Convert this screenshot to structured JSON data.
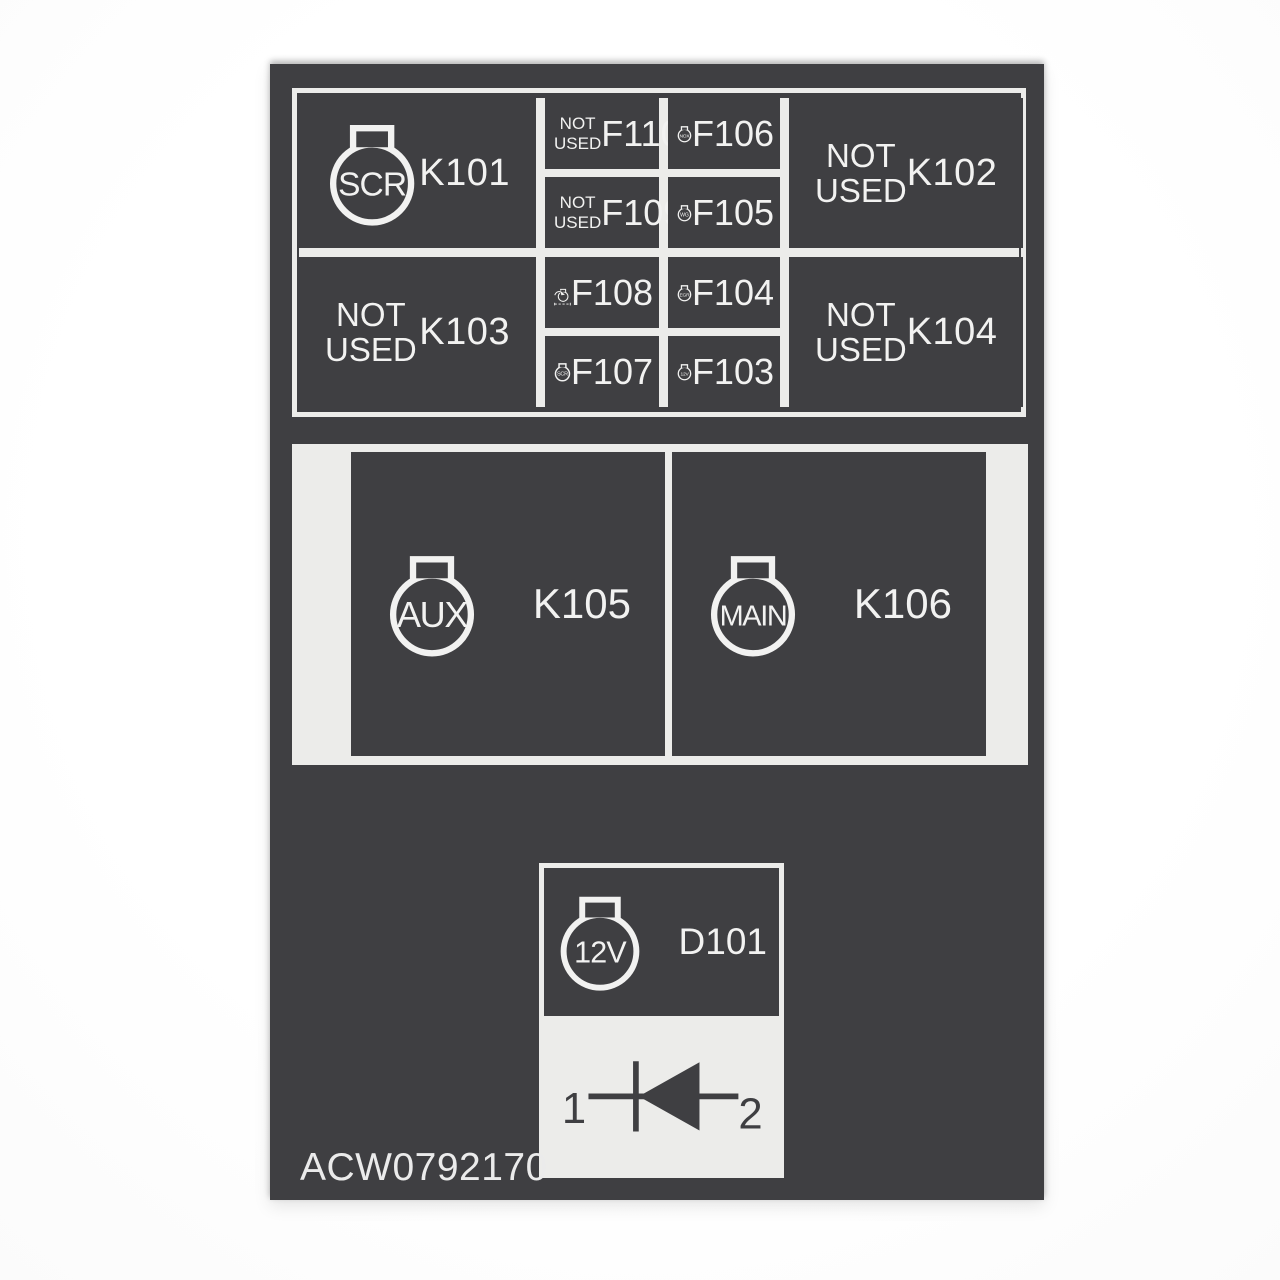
{
  "part_number": "ACW0792170",
  "colors": {
    "decal_background": "#3f3f42",
    "panel_white": "#ececea",
    "text_white": "#f2f2f1"
  },
  "relay_grid": {
    "k101": {
      "label": "K101",
      "icon_text": "SCR"
    },
    "k102": {
      "label": "K102",
      "note_line1": "NOT",
      "note_line2": "USED"
    },
    "k103": {
      "label": "K103",
      "note_line1": "NOT",
      "note_line2": "USED"
    },
    "k104": {
      "label": "K104",
      "note_line1": "NOT",
      "note_line2": "USED"
    },
    "f110": {
      "label": "F110",
      "note_line1": "NOT",
      "note_line2": "USED"
    },
    "f109": {
      "label": "F109",
      "note_line1": "NOT",
      "note_line2": "USED"
    },
    "f108": {
      "label": "F108"
    },
    "f107": {
      "label": "F107",
      "icon_text": "SCR"
    },
    "f106": {
      "label": "F106",
      "icon_text": "NOX"
    },
    "f105": {
      "label": "F105",
      "icon_text": "WG"
    },
    "f104": {
      "label": "F104",
      "icon_text": "EGR"
    },
    "f103": {
      "label": "F103",
      "icon_text": "12V"
    }
  },
  "main_relays": {
    "k105": {
      "label": "K105",
      "icon_text": "AUX"
    },
    "k106": {
      "label": "K106",
      "icon_text": "MAIN"
    }
  },
  "diode": {
    "label": "D101",
    "icon_text": "12V",
    "pin_left": "1",
    "pin_right": "2"
  }
}
